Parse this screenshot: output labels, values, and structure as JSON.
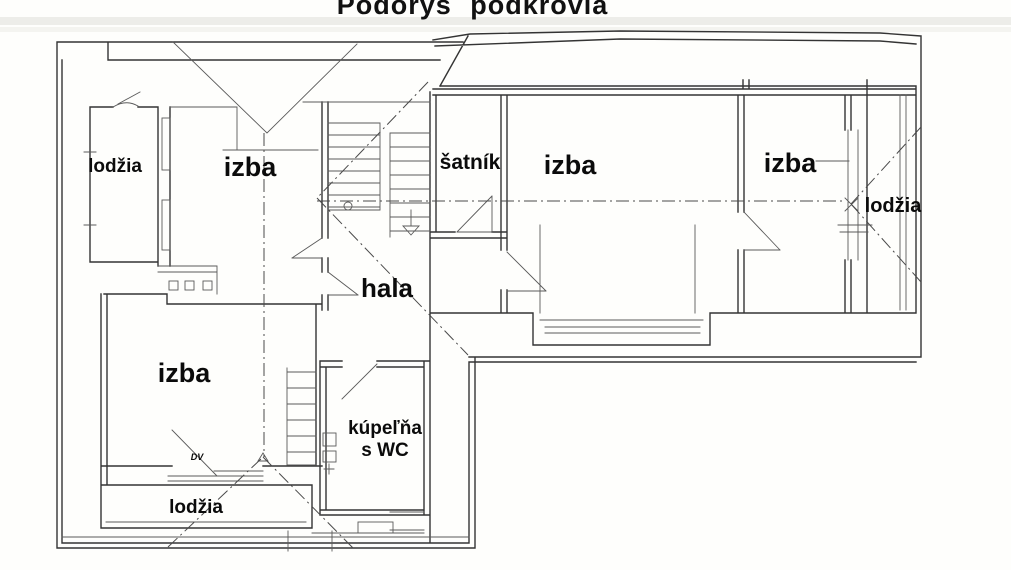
{
  "title": "Pôdorys podkrovia",
  "rooms": {
    "lodzia_top_left": {
      "label": "lodžia"
    },
    "izba_top_left": {
      "label": "izba"
    },
    "satnik": {
      "label": "šatník"
    },
    "izba_center": {
      "label": "izba"
    },
    "izba_right": {
      "label": "izba"
    },
    "lodzia_right": {
      "label": "lodžia"
    },
    "hala": {
      "label": "hala"
    },
    "izba_bottom": {
      "label": "izba"
    },
    "kupelna": {
      "line1": "kúpeľňa",
      "line2": "s WC"
    },
    "lodzia_bottom": {
      "label": "lodžia"
    }
  },
  "annotations": {
    "door_mark": "DV"
  },
  "colors": {
    "ink": "#343434",
    "thin_ink": "#5a5a5a",
    "paper": "#fefefc"
  }
}
